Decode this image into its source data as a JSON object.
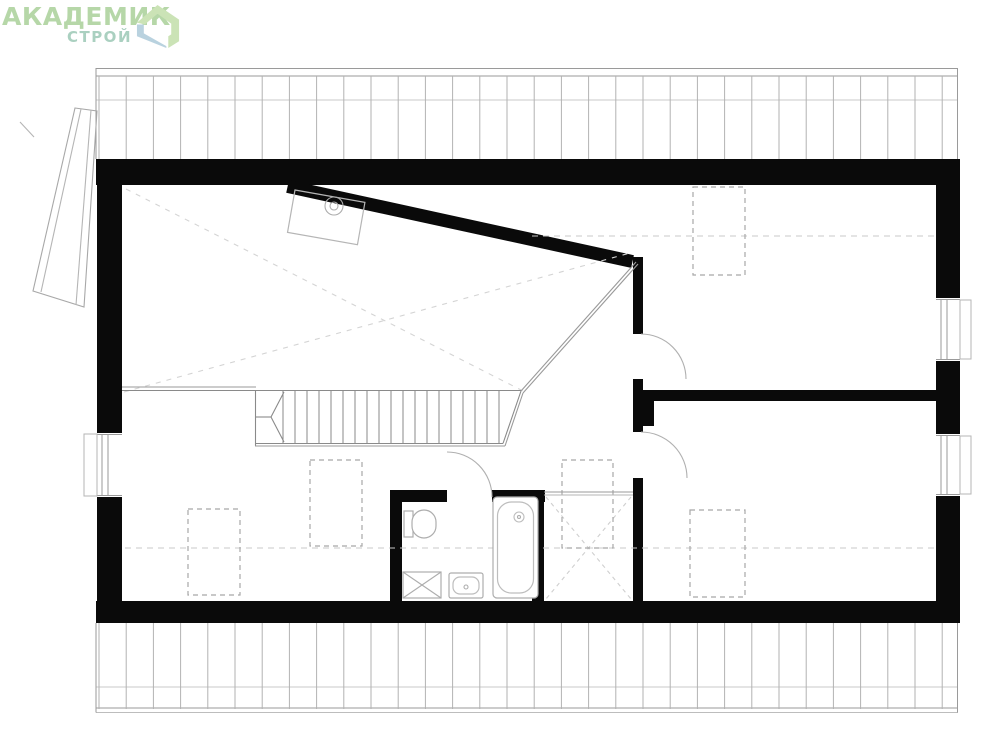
{
  "logo": {
    "title": "АКАДЕМИК",
    "subtitle": "СТРОЙ",
    "title_color": "#b6d7a8",
    "subtitle_color": "#aad0c0",
    "icon_green": "#cbe3b6",
    "icon_blue": "#b9d2df"
  },
  "plan": {
    "canvas": {
      "w": 999,
      "h": 741
    },
    "wall_color": "#0a0a0a",
    "elements": [
      {
        "t": "rect",
        "n": "top-wall",
        "x": 96,
        "y": 159,
        "w": 864,
        "h": 26,
        "f": "W"
      },
      {
        "t": "rect",
        "n": "bottom-wall",
        "x": 96,
        "y": 601,
        "w": 864,
        "h": 22,
        "f": "W"
      },
      {
        "t": "rect",
        "n": "left-wall-upper",
        "x": 97,
        "y": 159,
        "w": 25,
        "h": 275,
        "f": "W"
      },
      {
        "t": "rect",
        "n": "left-wall-lower",
        "x": 97,
        "y": 497,
        "w": 25,
        "h": 126,
        "f": "W"
      },
      {
        "t": "rect",
        "n": "right-wall-upper",
        "x": 936,
        "y": 185,
        "w": 24,
        "h": 113,
        "f": "W"
      },
      {
        "t": "rect",
        "n": "right-wall-middle",
        "x": 936,
        "y": 361,
        "w": 24,
        "h": 73,
        "f": "W"
      },
      {
        "t": "rect",
        "n": "right-wall-lower",
        "x": 936,
        "y": 496,
        "w": 24,
        "h": 127,
        "f": "W"
      },
      {
        "t": "rect",
        "n": "diagonal-wall",
        "x": 289,
        "y": 180,
        "w": 353,
        "h": 13,
        "f": "W",
        "rot": [
          12.3,
          289,
          180
        ]
      },
      {
        "t": "rect",
        "n": "hall-wall-upper",
        "x": 633,
        "y": 257,
        "w": 10,
        "h": 77,
        "f": "W"
      },
      {
        "t": "rect",
        "n": "hall-wall-middle",
        "x": 633,
        "y": 379,
        "w": 10,
        "h": 53,
        "f": "W"
      },
      {
        "t": "rect",
        "n": "hall-wall-lower",
        "x": 633,
        "y": 478,
        "w": 10,
        "h": 124,
        "f": "W"
      },
      {
        "t": "rect",
        "n": "partition-wall",
        "x": 643,
        "y": 390,
        "w": 293,
        "h": 11,
        "f": "W"
      },
      {
        "t": "rect",
        "n": "partition-pier",
        "x": 643,
        "y": 401,
        "w": 11,
        "h": 25,
        "f": "W"
      },
      {
        "t": "rect",
        "n": "bathroom-wall-top-left",
        "x": 390,
        "y": 490,
        "w": 57,
        "h": 12,
        "f": "W"
      },
      {
        "t": "rect",
        "n": "bathroom-wall-top-right",
        "x": 492,
        "y": 490,
        "w": 53,
        "h": 12,
        "f": "W"
      },
      {
        "t": "rect",
        "n": "bathroom-wall-left",
        "x": 390,
        "y": 490,
        "w": 12,
        "h": 112,
        "f": "W"
      },
      {
        "t": "rect",
        "n": "bathroom-wall-right",
        "x": 532,
        "y": 492,
        "w": 12,
        "h": 110,
        "f": "W"
      },
      {
        "t": "band",
        "n": "roof-hatch-top",
        "x1": 96,
        "x2": 958,
        "start": 99,
        "step": 27.2,
        "vy1": 76,
        "vy2": 159,
        "ey1": 68,
        "ey2": 159,
        "edges": [
          96,
          957.5
        ],
        "hlines": [
          {
            "y": 68.5,
            "c": "#9a9a9a"
          },
          {
            "y": 76,
            "c": "#9a9a9a"
          },
          {
            "y": 100,
            "c": "#c8c8c8"
          }
        ]
      },
      {
        "t": "band",
        "n": "roof-hatch-bottom",
        "x1": 96,
        "x2": 958,
        "start": 99,
        "step": 27.2,
        "vy1": 623,
        "vy2": 709,
        "ey1": 623,
        "ey2": 712.5,
        "edges": [
          96,
          957.5
        ],
        "hlines": [
          {
            "y": 687,
            "c": "#c8c8c8"
          },
          {
            "y": 708,
            "c": "#9a9a9a"
          },
          {
            "y": 712.5,
            "c": "#bdbdbd"
          }
        ]
      },
      {
        "t": "window",
        "n": "window-left",
        "x": 97,
        "y": 433,
        "w": 25,
        "h": 64,
        "lines": [
          102,
          108
        ],
        "sill": {
          "x": 84,
          "y": 434,
          "w": 13,
          "h": 62
        }
      },
      {
        "t": "window",
        "n": "window-right-upper",
        "x": 936,
        "y": 298,
        "w": 24,
        "h": 63,
        "lines": [
          941,
          947
        ],
        "sill": {
          "x": 960,
          "y": 300,
          "w": 11,
          "h": 59
        }
      },
      {
        "t": "window",
        "n": "window-right-lower",
        "x": 936,
        "y": 434,
        "w": 24,
        "h": 62,
        "lines": [
          941,
          947
        ],
        "sill": {
          "x": 960,
          "y": 436,
          "w": 11,
          "h": 58
        }
      },
      {
        "t": "line",
        "n": "height-line-top",
        "x1": 532,
        "y1": 236,
        "x2": 934,
        "y2": 236,
        "c": "#c8c8c8",
        "dash": "6 5"
      },
      {
        "t": "line",
        "n": "height-line-bottom",
        "x1": 125,
        "y1": 548,
        "x2": 934,
        "y2": 548,
        "c": "#c8c8c8",
        "dash": "6 5"
      },
      {
        "t": "line",
        "n": "ceiling-slope-line-a",
        "x1": 126,
        "y1": 189,
        "x2": 523,
        "y2": 391,
        "c": "#d4d4d4",
        "dash": "5 6"
      },
      {
        "t": "line",
        "n": "ceiling-slope-line-b",
        "x1": 124,
        "y1": 392,
        "x2": 630,
        "y2": 253,
        "c": "#d4d4d4",
        "dash": "5 6"
      },
      {
        "t": "line",
        "n": "closet-cross-a",
        "x1": 546,
        "y1": 497,
        "x2": 631,
        "y2": 599,
        "c": "#cfcfcf",
        "dash": "4 4"
      },
      {
        "t": "line",
        "n": "closet-cross-b",
        "x1": 631,
        "y1": 497,
        "x2": 546,
        "y2": 599,
        "c": "#cfcfcf",
        "dash": "4 4"
      },
      {
        "t": "rect",
        "n": "roof-window",
        "x": 693,
        "y": 187,
        "w": 52,
        "h": 88,
        "s": "#a8a8a8",
        "dash": "5 4"
      },
      {
        "t": "rect",
        "n": "roof-window",
        "x": 690,
        "y": 510,
        "w": 55,
        "h": 87,
        "s": "#a8a8a8",
        "dash": "5 4"
      },
      {
        "t": "rect",
        "n": "roof-window",
        "x": 188,
        "y": 509,
        "w": 52,
        "h": 86,
        "s": "#a8a8a8",
        "dash": "5 4"
      },
      {
        "t": "rect",
        "n": "roof-window",
        "x": 310,
        "y": 460,
        "w": 52,
        "h": 86,
        "s": "#a8a8a8",
        "dash": "5 4"
      },
      {
        "t": "rect",
        "n": "roof-window",
        "x": 562,
        "y": 460,
        "w": 51,
        "h": 88,
        "s": "#a8a8a8",
        "dash": "5 4"
      },
      {
        "t": "line",
        "n": "landing-edge",
        "x1": 122,
        "y1": 387,
        "x2": 256,
        "y2": 387,
        "c": "#9a9a9a"
      },
      {
        "t": "line",
        "n": "stairs-top-edge",
        "x1": 122,
        "y1": 390.5,
        "x2": 521,
        "y2": 390.5,
        "c": "#8a8a8a"
      },
      {
        "t": "line",
        "n": "closet-front-a",
        "x1": 544,
        "y1": 492,
        "x2": 633,
        "y2": 492,
        "c": "#9a9a9a"
      },
      {
        "t": "line",
        "n": "closet-front-b",
        "x1": 544,
        "y1": 495,
        "x2": 633,
        "y2": 495,
        "c": "#b5b5b5"
      },
      {
        "t": "line",
        "n": "stairs-left-edge",
        "x1": 255.5,
        "y1": 391,
        "x2": 255.5,
        "y2": 446,
        "c": "#8a8a8a"
      },
      {
        "t": "line",
        "n": "stairs-bottom-edge",
        "x1": 255,
        "y1": 443.5,
        "x2": 503,
        "y2": 443.5,
        "c": "#8a8a8a"
      },
      {
        "t": "line",
        "n": "stairs-bottom-edge2",
        "x1": 255,
        "y1": 446,
        "x2": 505,
        "y2": 446,
        "c": "#9a9a9a"
      },
      {
        "t": "treads",
        "n": "stairs-treads",
        "x1": 283,
        "x2": 499,
        "step": 12,
        "y1": 391,
        "y2": 443,
        "c": "#8a8a8a"
      },
      {
        "t": "path",
        "n": "stairs-break-line",
        "d": "M 284,392 L 271,417 L 284,442",
        "c": "#8a8a8a"
      },
      {
        "t": "line",
        "n": "stairs-break-line2",
        "x1": 255,
        "y1": 417,
        "x2": 271,
        "y2": 417,
        "c": "#8a8a8a"
      },
      {
        "t": "line",
        "n": "stairs-chamfer",
        "x1": 503,
        "y1": 443.5,
        "x2": 521,
        "y2": 391,
        "c": "#8a8a8a"
      },
      {
        "t": "line",
        "n": "stairs-chamfer2",
        "x1": 505,
        "y1": 446,
        "x2": 523,
        "y2": 393,
        "c": "#9a9a9a"
      },
      {
        "t": "line",
        "n": "stairwell-void-edge-a",
        "x1": 521,
        "y1": 391,
        "x2": 636,
        "y2": 262,
        "c": "#9a9a9a"
      },
      {
        "t": "line",
        "n": "stairwell-void-edge-b",
        "x1": 523,
        "y1": 393,
        "x2": 638,
        "y2": 264,
        "c": "#9a9a9a"
      },
      {
        "t": "path",
        "n": "door-arc-bedroom-right",
        "d": "M 641,334 A 45 45 0 0 1 686,379",
        "c": "#b0b0b0"
      },
      {
        "t": "path",
        "n": "door-arc-bedroom-lower",
        "d": "M 641,432 A 46 46 0 0 1 687,478",
        "c": "#b0b0b0"
      },
      {
        "t": "path",
        "n": "door-arc-bathroom",
        "d": "M 447,452 A 45 45 0 0 1 492,497",
        "c": "#b0b0b0"
      },
      {
        "t": "rect",
        "n": "toilet-tank",
        "x": 404,
        "y": 511,
        "w": 9,
        "h": 26,
        "s": "#adadad",
        "f": "#fff"
      },
      {
        "t": "rect",
        "n": "toilet-bowl",
        "x": 412,
        "y": 510,
        "w": 24,
        "h": 28,
        "rx": 12,
        "s": "#adadad",
        "f": "#fff"
      },
      {
        "t": "rect",
        "n": "washing-machine",
        "x": 403,
        "y": 572,
        "w": 38,
        "h": 26,
        "s": "#adadad",
        "f": "#fff"
      },
      {
        "t": "line",
        "n": "washing-machine-cross-a",
        "x1": 403,
        "y1": 572,
        "x2": 441,
        "y2": 598,
        "c": "#adadad"
      },
      {
        "t": "line",
        "n": "washing-machine-cross-b",
        "x1": 441,
        "y1": 572,
        "x2": 403,
        "y2": 598,
        "c": "#adadad"
      },
      {
        "t": "rect",
        "n": "sink-counter",
        "x": 449,
        "y": 573,
        "w": 34,
        "h": 25,
        "rx": 2,
        "s": "#adadad",
        "f": "#fff"
      },
      {
        "t": "rect",
        "n": "sink-basin",
        "x": 453,
        "y": 577,
        "w": 26,
        "h": 17,
        "rx": 7,
        "s": "#bdbdbd"
      },
      {
        "t": "circle",
        "n": "sink-faucet",
        "cx": 466,
        "cy": 587,
        "r": 2,
        "s": "#adadad"
      },
      {
        "t": "rect",
        "n": "bathtub",
        "x": 493,
        "y": 497,
        "w": 45,
        "h": 101,
        "rx": 4,
        "s": "#adadad",
        "f": "#fff"
      },
      {
        "t": "rect",
        "n": "bathtub-inner",
        "x": 497.5,
        "y": 502,
        "w": 36,
        "h": 91,
        "rx": 14,
        "s": "#bdbdbd"
      },
      {
        "t": "circle",
        "n": "bathtub-drain",
        "cx": 519,
        "cy": 517,
        "r": 5,
        "s": "#bdbdbd"
      },
      {
        "t": "circle",
        "n": "bathtub-drain-dot",
        "cx": 519,
        "cy": 517,
        "r": 1.5,
        "s": "#adadad"
      },
      {
        "t": "rect",
        "n": "chimney-block",
        "x": 295,
        "y": 190,
        "w": 71,
        "h": 43,
        "s": "#b5b5b5",
        "rot": [
          10,
          295,
          190
        ]
      },
      {
        "t": "circle",
        "n": "chimney-flue-outer",
        "cx": 334,
        "cy": 206,
        "r": 9,
        "s": "#adadad"
      },
      {
        "t": "circle",
        "n": "chimney-flue-inner",
        "cx": 334,
        "cy": 206,
        "r": 4,
        "s": "#adadad"
      },
      {
        "t": "poly",
        "n": "roof-panel",
        "pts": "75,108 97,111 84,307 33,291",
        "s": "#a8a8a8"
      },
      {
        "t": "line",
        "n": "roof-panel-line-a",
        "x1": 81,
        "y1": 109,
        "x2": 41,
        "y2": 292,
        "c": "#b5b5b5"
      },
      {
        "t": "line",
        "n": "roof-panel-line-b",
        "x1": 91,
        "y1": 110,
        "x2": 76,
        "y2": 305,
        "c": "#b5b5b5"
      },
      {
        "t": "line",
        "n": "roof-panel-tick",
        "x1": 20,
        "y1": 122,
        "x2": 34,
        "y2": 137,
        "c": "#b5b5b5"
      }
    ]
  }
}
